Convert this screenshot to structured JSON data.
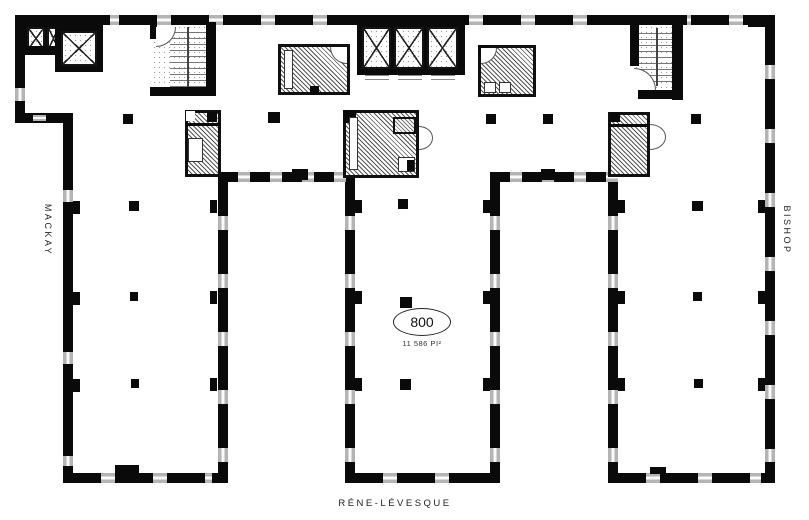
{
  "plan": {
    "title": "floor-plan",
    "streets": {
      "left": "MACKAY",
      "right": "BISHOP",
      "bottom": "RÉNE-LÉVESQUE"
    },
    "unit": {
      "number": "800",
      "area": "11 586 PI²"
    },
    "colors": {
      "wall": "#0a0a0a",
      "window": "#b4b4b4",
      "paper": "#ffffff",
      "hatch": "#555555"
    }
  }
}
